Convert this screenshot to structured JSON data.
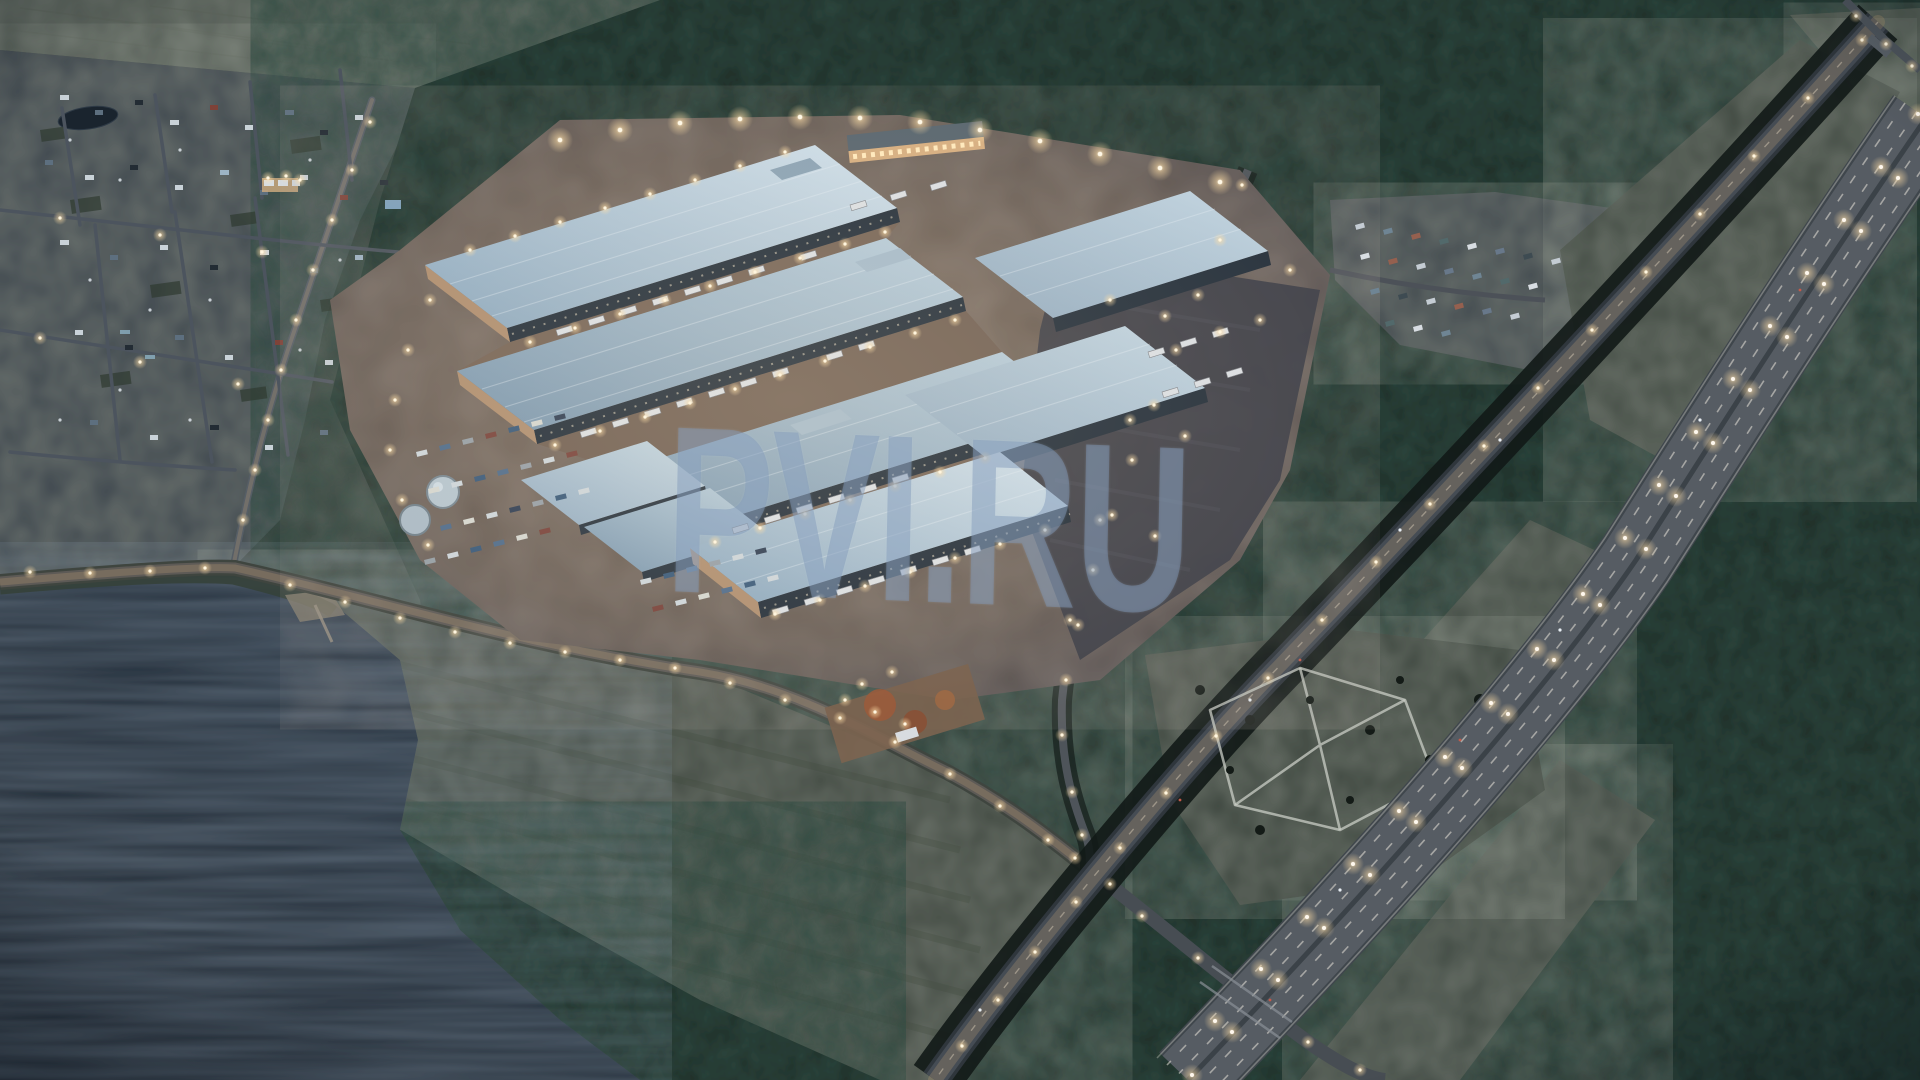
{
  "watermark": {
    "text": "PVI.RU"
  },
  "palette": {
    "forest": "#15201c",
    "water": "#1f2b36",
    "roof_light": "#cfdde8",
    "roof_mid": "#9cb6c8",
    "pavement_warm": "#75665a",
    "asphalt": "#4a4f55",
    "lamp_glow": "#ffdfa8",
    "grass": "#39423a",
    "village_ground": "#343e49",
    "watermark_color": "rgba(126,151,182,0.46)"
  }
}
